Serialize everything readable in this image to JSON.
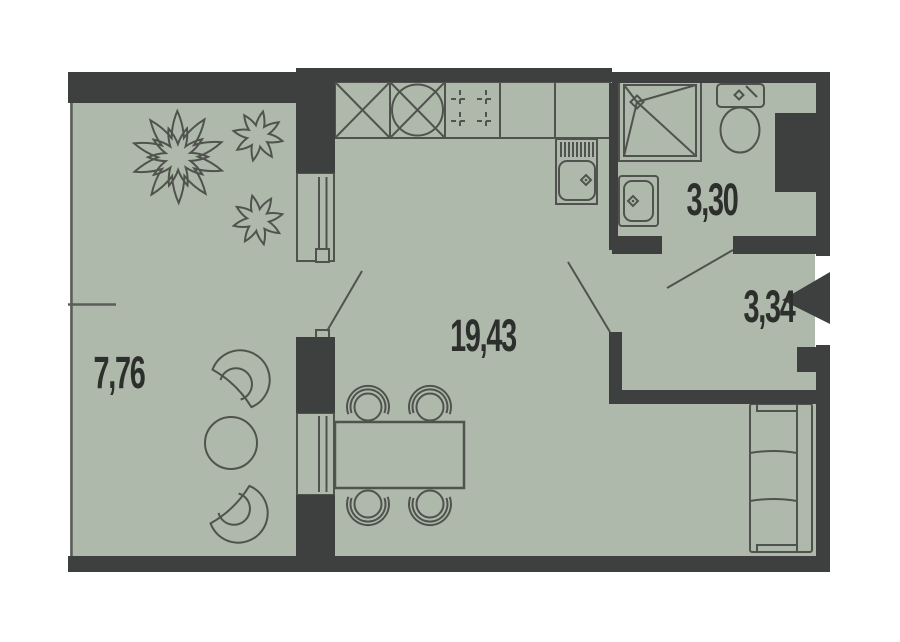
{
  "plan": {
    "rooms": [
      {
        "name": "living-kitchen",
        "area": "19,43"
      },
      {
        "name": "balcony",
        "area": "7,76"
      },
      {
        "name": "bathroom",
        "area": "3,30"
      },
      {
        "name": "hallway",
        "area": "3,34"
      }
    ],
    "colors": {
      "floor": "#aeb9ab",
      "wall": "#3d403e",
      "line": "#50534d",
      "thin": "#5a5d57",
      "text": "#2d2f2c",
      "bg": "#ffffff"
    }
  }
}
